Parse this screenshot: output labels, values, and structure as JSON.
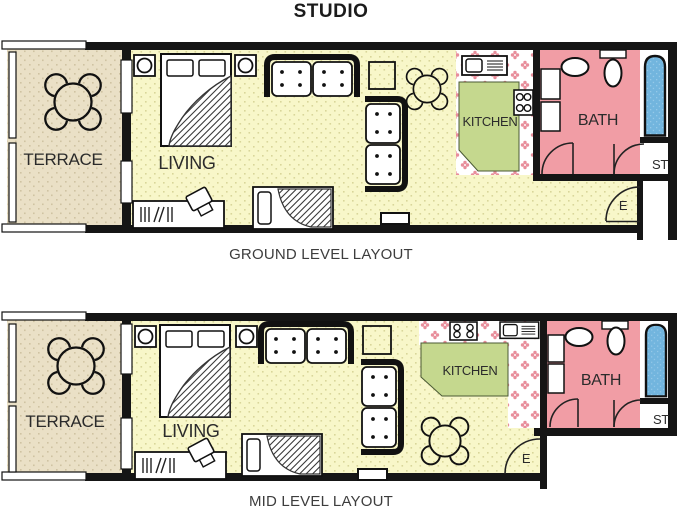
{
  "title": "STUDIO",
  "colors": {
    "wall": "#151515",
    "living_floor": "#f8f7c9",
    "living_speckle": "#d9d69a",
    "terrace_floor": "#eae0c6",
    "terrace_speckle": "#cfc3a2",
    "kitchen_floor": "#c5d88e",
    "bath_floor": "#f19da5",
    "tile_flower": "#e88e9b",
    "tub": "#72b5de",
    "tub_speckle": "#95c9e9"
  },
  "ground": {
    "caption": "GROUND LEVEL LAYOUT",
    "labels": {
      "terrace": "TERRACE",
      "living": "LIVING",
      "kitchen": "KITCHEN",
      "bath": "BATH",
      "storage": "ST",
      "entrance": "E"
    }
  },
  "mid": {
    "caption": "MID LEVEL LAYOUT",
    "labels": {
      "terrace": "TERRACE",
      "living": "LIVING",
      "kitchen": "KITCHEN",
      "bath": "BATH",
      "storage": "ST",
      "entrance": "E"
    }
  }
}
